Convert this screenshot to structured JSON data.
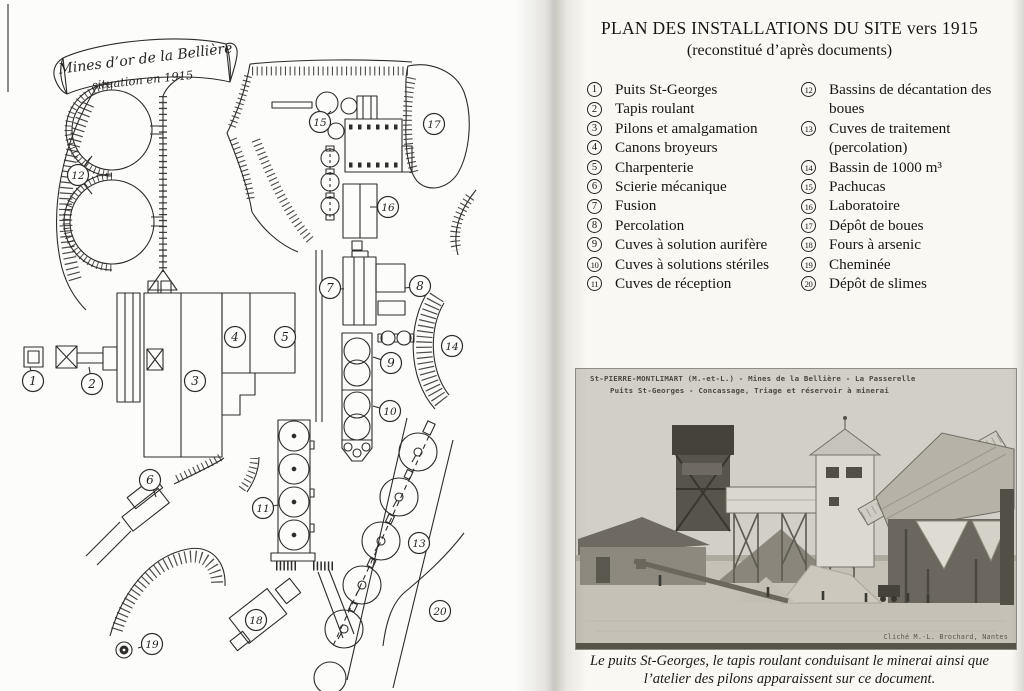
{
  "document": {
    "title_line1": "PLAN DES INSTALLATIONS DU SITE vers 1915",
    "title_line2": "(reconstitué d’après documents)"
  },
  "map": {
    "banner": {
      "line1": "Mines d’or de la Bellière",
      "line2": "situation en 1915"
    },
    "markers": [
      {
        "n": "1",
        "x": 33,
        "y": 381,
        "lx": 30,
        "ly": 367
      },
      {
        "n": "2",
        "x": 92,
        "y": 384,
        "lx": 89,
        "ly": 367
      },
      {
        "n": "3",
        "x": 195,
        "y": 381
      },
      {
        "n": "4",
        "x": 235,
        "y": 337
      },
      {
        "n": "5",
        "x": 285,
        "y": 337
      },
      {
        "n": "6",
        "x": 150,
        "y": 480,
        "lx": 156,
        "ly": 497
      },
      {
        "n": "7",
        "x": 330,
        "y": 288,
        "lx": 344,
        "ly": 289
      },
      {
        "n": "8",
        "x": 420,
        "y": 286,
        "lx": 405,
        "ly": 288
      },
      {
        "n": "9",
        "x": 391,
        "y": 363,
        "lx": 373,
        "ly": 357
      },
      {
        "n": "10",
        "x": 390,
        "y": 411,
        "lx": 373,
        "ly": 406
      },
      {
        "n": "11",
        "x": 263,
        "y": 508,
        "lx": 278,
        "ly": 505
      },
      {
        "n": "12",
        "x": 78,
        "y": 175,
        "lx": 90,
        "ly": 158
      },
      {
        "n": "13",
        "x": 419,
        "y": 543
      },
      {
        "n": "14",
        "x": 452,
        "y": 346
      },
      {
        "n": "15",
        "x": 320,
        "y": 122,
        "lx": 331,
        "ly": 111
      },
      {
        "n": "16",
        "x": 388,
        "y": 207,
        "lx": 370,
        "ly": 207
      },
      {
        "n": "17",
        "x": 434,
        "y": 124
      },
      {
        "n": "18",
        "x": 256,
        "y": 620
      },
      {
        "n": "19",
        "x": 152,
        "y": 644,
        "lx": 138,
        "ly": 648
      },
      {
        "n": "20",
        "x": 440,
        "y": 611
      }
    ]
  },
  "legend": {
    "left": [
      {
        "num": "1",
        "label": "Puits St-Georges"
      },
      {
        "num": "2",
        "label": "Tapis roulant"
      },
      {
        "num": "3",
        "label": "Pilons et amalgamation"
      },
      {
        "num": "4",
        "label": "Canons broyeurs"
      },
      {
        "num": "5",
        "label": "Charpenterie"
      },
      {
        "num": "6",
        "label": "Scierie mécanique"
      },
      {
        "num": "7",
        "label": "Fusion"
      },
      {
        "num": "8",
        "label": "Percolation"
      },
      {
        "num": "9",
        "label": "Cuves à solution aurifère"
      },
      {
        "num": "10",
        "label": "Cuves à solutions stériles"
      },
      {
        "num": "11",
        "label": "Cuves de réception"
      }
    ],
    "right": [
      {
        "num": "12",
        "label": "Bassins de décantation des boues"
      },
      {
        "num": "13",
        "label": "Cuves de traitement (percolation)"
      },
      {
        "num": "14",
        "label": "Bassin de 1000 m³"
      },
      {
        "num": "15",
        "label": "Pachucas"
      },
      {
        "num": "16",
        "label": "Laboratoire"
      },
      {
        "num": "17",
        "label": "Dépôt de boues"
      },
      {
        "num": "18",
        "label": "Fours à arsenic"
      },
      {
        "num": "19",
        "label": "Cheminée"
      },
      {
        "num": "20",
        "label": "Dépôt de slimes"
      }
    ]
  },
  "photo": {
    "header_line1": "St-PIERRE-MONTLIMART (M.-et-L.) - Mines de la Bellière - La Passerelle",
    "header_line2": "Puits St-Georges - Concassage, Triage et réservoir à minerai",
    "credit": "Cliché M.-L. Brochard, Nantes"
  },
  "caption": {
    "line1": "Le puits St-Georges, le tapis roulant conduisant le minerai ainsi que",
    "line2": "l’atelier des pilons apparaissent sur ce document."
  }
}
